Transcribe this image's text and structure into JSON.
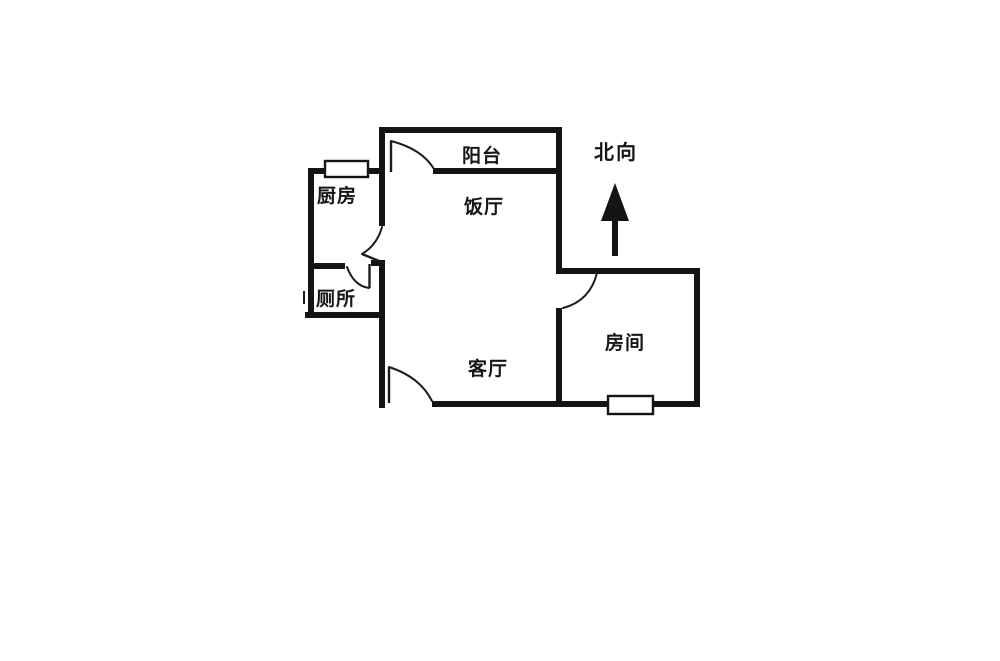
{
  "floorplan": {
    "north_label": "北向",
    "rooms": [
      {
        "id": "kitchen",
        "label": "厨房"
      },
      {
        "id": "toilet",
        "label": "厕所"
      },
      {
        "id": "balcony",
        "label": "阳台"
      },
      {
        "id": "dining",
        "label": "饭厅"
      },
      {
        "id": "living",
        "label": "客厅"
      },
      {
        "id": "bedroom",
        "label": "房间"
      }
    ],
    "features": {
      "windows": [
        "kitchen-window",
        "bedroom-window"
      ],
      "doors": [
        "balcony-door",
        "dining-door",
        "toilet-door",
        "bedroom-door",
        "entrance-door"
      ]
    },
    "colors": {
      "wall": "#141414",
      "line": "#1c1c1c",
      "background": "#ffffff"
    }
  }
}
